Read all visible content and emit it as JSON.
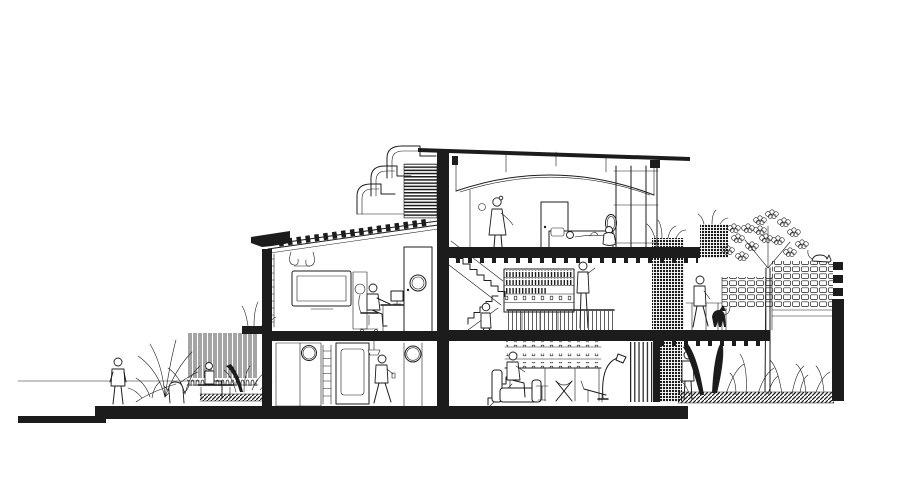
{
  "canvas": {
    "width_px": 900,
    "height_px": 504
  },
  "palette": {
    "ink": "#1c1c1c",
    "paper": "#ffffff"
  },
  "labels": {
    "drawing": "Sectional perspective drawing of a three-storey house",
    "street": "Street side with pedestrian, palm planting, picket fence and bench",
    "media_room": "First-floor media room with wall-mounted TV and desk workstation",
    "ground_room": "Ground-floor room with porthole doors, ladder and figure on phone",
    "clerestory": "Stepped vault eaves with louvred screen",
    "roof": "Flat canopy over curved vault roof",
    "bedroom": "Top-floor bedroom with bed, mirror and figures",
    "stair": "Central staircase with climbing figure",
    "library": "Mezzanine book shelves with browsing figure",
    "living": "Ground-floor living room with sofa, chairs and arc lamp",
    "terrace": "Planted terrace behind perforated brick screens with walker and dog",
    "garden": "Rear garden with tree, shrubs, breeze-block fence and cat"
  }
}
